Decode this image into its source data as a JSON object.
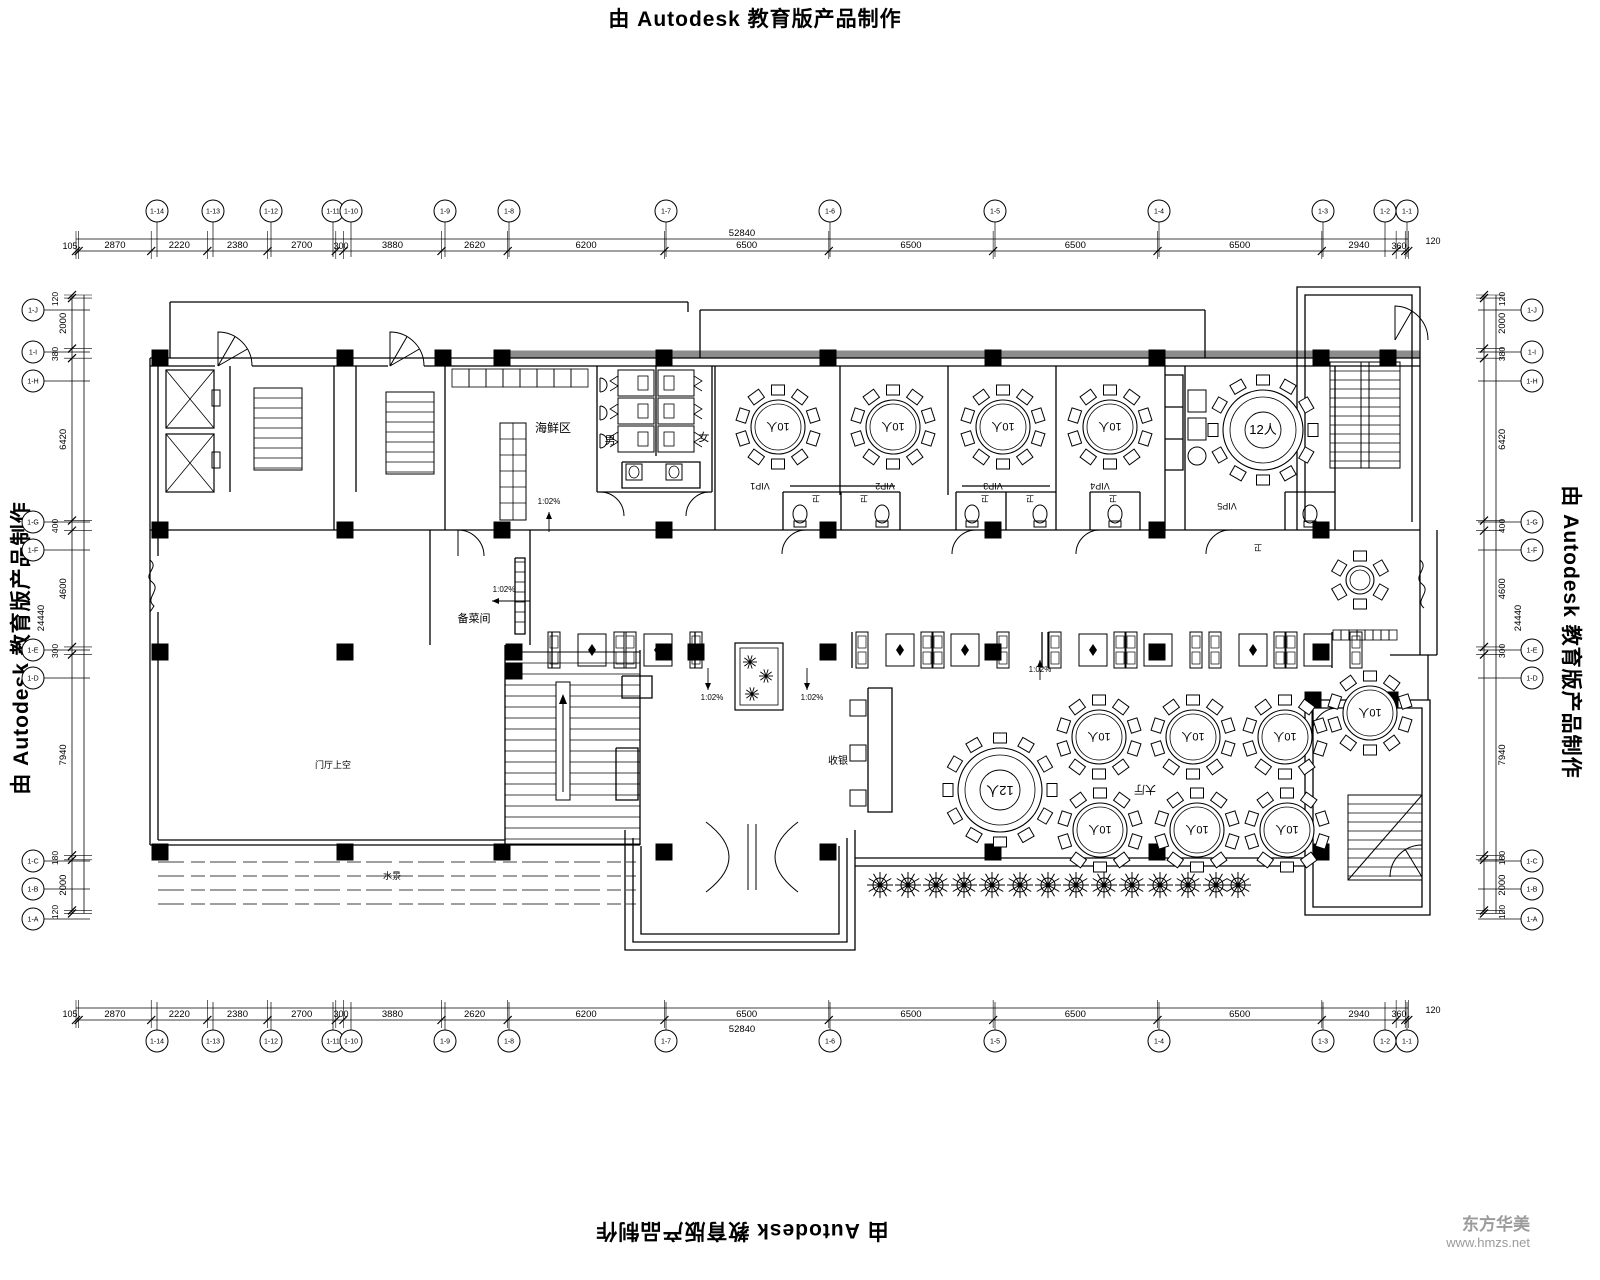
{
  "banner": {
    "text": "由 Autodesk 教育版产品制作"
  },
  "watermark": {
    "company": "东方华美",
    "url": "www.hmzs.net"
  },
  "colors": {
    "ink": "#000000",
    "band": "#8c8c8c",
    "watermark": "#9b9b9b"
  },
  "dimensions": {
    "scale_px_per_mm": 0.025283,
    "horizontal_segments": [
      105,
      2870,
      2220,
      2380,
      2700,
      300,
      3880,
      2620,
      6200,
      6500,
      6500,
      6500,
      6500,
      2940,
      360,
      120
    ],
    "vertical_segments": [
      120,
      2000,
      380,
      6420,
      400,
      4600,
      300,
      7940,
      180,
      2000,
      120
    ],
    "horizontal_overall": "52840",
    "vertical_overall": "24440",
    "top": {
      "origin_x": 76,
      "line_y": 239,
      "line_y2": 251,
      "label_y": 248,
      "overall_xy": [
        742,
        236
      ],
      "extra_labels": [
        {
          "t": "105",
          "x": 70,
          "y": 249
        },
        {
          "t": "300",
          "x": 341,
          "y": 249
        },
        {
          "t": "360",
          "x": 1399,
          "y": 249
        },
        {
          "t": "120",
          "x": 1433,
          "y": 244
        }
      ]
    },
    "bottom": {
      "origin_x": 76,
      "line_y": 1008,
      "line_y2": 1020,
      "label_y": 1017,
      "overall_xy": [
        742,
        1032
      ],
      "extra_labels": [
        {
          "t": "105",
          "x": 70,
          "y": 1017
        },
        {
          "t": "300",
          "x": 341,
          "y": 1017
        },
        {
          "t": "360",
          "x": 1399,
          "y": 1017
        },
        {
          "t": "120",
          "x": 1433,
          "y": 1013
        }
      ]
    },
    "left": {
      "origin_y": 295,
      "line_x": 72,
      "line_x2": 84,
      "label_x": 66,
      "overall_xy": [
        44,
        618
      ],
      "extra_labels": [
        {
          "t": "120",
          "x": 58,
          "y": 299
        },
        {
          "t": "380",
          "x": 58,
          "y": 354
        },
        {
          "t": "400",
          "x": 58,
          "y": 526
        },
        {
          "t": "300",
          "x": 58,
          "y": 651
        },
        {
          "t": "180",
          "x": 58,
          "y": 858
        },
        {
          "t": "120",
          "x": 58,
          "y": 912
        }
      ]
    },
    "right": {
      "origin_y": 295,
      "line_x": 1484,
      "line_x2": 1496,
      "label_x": 1505,
      "overall_xy": [
        1521,
        618
      ],
      "extra_labels": [
        {
          "t": "120",
          "x": 1505,
          "y": 299
        },
        {
          "t": "380",
          "x": 1505,
          "y": 354
        },
        {
          "t": "400",
          "x": 1505,
          "y": 526
        },
        {
          "t": "300",
          "x": 1505,
          "y": 651
        },
        {
          "t": "180",
          "x": 1505,
          "y": 858
        },
        {
          "t": "120",
          "x": 1505,
          "y": 912
        }
      ]
    }
  },
  "grid_bubbles": {
    "radius": 11,
    "top_y": 211,
    "bottom_y": 1041,
    "left_x": 33,
    "right_x": 1532,
    "columns": [
      {
        "x": 157,
        "label": "1-14"
      },
      {
        "x": 213,
        "label": "1-13"
      },
      {
        "x": 271,
        "label": "1-12"
      },
      {
        "x": 333,
        "label": "1-11"
      },
      {
        "x": 351,
        "label": "1-10"
      },
      {
        "x": 445,
        "label": "1-9"
      },
      {
        "x": 509,
        "label": "1-8"
      },
      {
        "x": 666,
        "label": "1-7"
      },
      {
        "x": 830,
        "label": "1-6"
      },
      {
        "x": 995,
        "label": "1-5"
      },
      {
        "x": 1159,
        "label": "1-4"
      },
      {
        "x": 1323,
        "label": "1-3"
      },
      {
        "x": 1385,
        "label": "1-2"
      },
      {
        "x": 1407,
        "label": "1-1"
      }
    ],
    "rows": [
      {
        "y": 310,
        "label": "1-J"
      },
      {
        "y": 352,
        "label": "1-I"
      },
      {
        "y": 381,
        "label": "1-H"
      },
      {
        "y": 522,
        "label": "1-G"
      },
      {
        "y": 550,
        "label": "1-F"
      },
      {
        "y": 650,
        "label": "1-E"
      },
      {
        "y": 678,
        "label": "1-D"
      },
      {
        "y": 861,
        "label": "1-C"
      },
      {
        "y": 889,
        "label": "1-B"
      },
      {
        "y": 919,
        "label": "1-A"
      }
    ]
  },
  "rooms": {
    "labels": [
      {
        "t": "海鲜区",
        "x": 553,
        "y": 432,
        "s": 12,
        "rot": 0
      },
      {
        "t": "男",
        "x": 610,
        "y": 444,
        "s": 11,
        "rot": 0
      },
      {
        "t": "女",
        "x": 704,
        "y": 441,
        "s": 11,
        "rot": 0
      },
      {
        "t": "VIP1",
        "x": 760,
        "y": 483,
        "s": 9,
        "rot": 180
      },
      {
        "t": "VIP2",
        "x": 885,
        "y": 483,
        "s": 9,
        "rot": 180
      },
      {
        "t": "VIP3",
        "x": 993,
        "y": 483,
        "s": 9,
        "rot": 180
      },
      {
        "t": "VIP4",
        "x": 1100,
        "y": 483,
        "s": 9,
        "rot": 180
      },
      {
        "t": "VIP5",
        "x": 1227,
        "y": 503,
        "s": 9,
        "rot": 180
      },
      {
        "t": "卫",
        "x": 816,
        "y": 496,
        "s": 8,
        "rot": 180
      },
      {
        "t": "卫",
        "x": 864,
        "y": 496,
        "s": 8,
        "rot": 180
      },
      {
        "t": "卫",
        "x": 985,
        "y": 496,
        "s": 8,
        "rot": 180
      },
      {
        "t": "卫",
        "x": 1030,
        "y": 496,
        "s": 8,
        "rot": 180
      },
      {
        "t": "卫",
        "x": 1113,
        "y": 496,
        "s": 8,
        "rot": 180
      },
      {
        "t": "卫",
        "x": 1258,
        "y": 545,
        "s": 8,
        "rot": 180
      },
      {
        "t": "备菜间",
        "x": 474,
        "y": 622,
        "s": 11,
        "rot": 0
      },
      {
        "t": "收银",
        "x": 838,
        "y": 764,
        "s": 10,
        "rot": 0
      },
      {
        "t": "大厅",
        "x": 1145,
        "y": 786,
        "s": 11,
        "rot": 180
      },
      {
        "t": "门厅上空",
        "x": 333,
        "y": 768,
        "s": 9,
        "rot": 0
      },
      {
        "t": "水景",
        "x": 392,
        "y": 879,
        "s": 9,
        "rot": 0
      }
    ]
  },
  "notes": {
    "slope_text": "1:02%",
    "items": [
      {
        "x": 549,
        "y": 504,
        "arrow": [
          549,
          532,
          549,
          512
        ]
      },
      {
        "x": 504,
        "y": 592,
        "arrow": [
          530,
          601,
          492,
          601
        ]
      },
      {
        "x": 712,
        "y": 700,
        "arrow": [
          708,
          668,
          708,
          690
        ]
      },
      {
        "x": 812,
        "y": 700,
        "arrow": [
          807,
          668,
          807,
          690
        ]
      },
      {
        "x": 1040,
        "y": 672,
        "arrow": [
          1040,
          680,
          1040,
          660
        ]
      }
    ]
  },
  "tables": {
    "round": [
      {
        "x": 778,
        "y": 427,
        "r": 27,
        "chairs": 10,
        "label": "10人",
        "rot": 180,
        "ls": 11
      },
      {
        "x": 893,
        "y": 427,
        "r": 27,
        "chairs": 10,
        "label": "10人",
        "rot": 180,
        "ls": 11
      },
      {
        "x": 1003,
        "y": 427,
        "r": 27,
        "chairs": 10,
        "label": "10人",
        "rot": 180,
        "ls": 11
      },
      {
        "x": 1110,
        "y": 427,
        "r": 27,
        "chairs": 10,
        "label": "10人",
        "rot": 180,
        "ls": 11
      },
      {
        "x": 1263,
        "y": 430,
        "r": 40,
        "chairs": 12,
        "label": "12人",
        "rot": 0,
        "ls": 13,
        "ring": 33,
        "core": 18
      },
      {
        "x": 1000,
        "y": 790,
        "r": 42,
        "chairs": 12,
        "label": "12人",
        "rot": 180,
        "ls": 13,
        "ring": 35,
        "core": 20
      },
      {
        "x": 1099,
        "y": 737,
        "r": 27,
        "chairs": 10,
        "label": "10人",
        "rot": 180,
        "ls": 11
      },
      {
        "x": 1193,
        "y": 737,
        "r": 27,
        "chairs": 10,
        "label": "10人",
        "rot": 180,
        "ls": 11
      },
      {
        "x": 1285,
        "y": 737,
        "r": 27,
        "chairs": 10,
        "label": "10人",
        "rot": 180,
        "ls": 11
      },
      {
        "x": 1100,
        "y": 830,
        "r": 27,
        "chairs": 10,
        "label": "10人",
        "rot": 180,
        "ls": 11
      },
      {
        "x": 1197,
        "y": 830,
        "r": 27,
        "chairs": 10,
        "label": "10人",
        "rot": 180,
        "ls": 11
      },
      {
        "x": 1287,
        "y": 830,
        "r": 27,
        "chairs": 10,
        "label": "10人",
        "rot": 180,
        "ls": 11
      },
      {
        "x": 1370,
        "y": 713,
        "r": 27,
        "chairs": 10,
        "label": "10人",
        "rot": 180,
        "ls": 11
      },
      {
        "x": 1360,
        "y": 580,
        "r": 14,
        "chairs": 6,
        "label": "",
        "rot": 0,
        "ls": 0
      }
    ]
  },
  "booths": {
    "centers": [
      592,
      658,
      900,
      965,
      1093,
      1158,
      1253,
      1318
    ],
    "y": 632
  },
  "trees": {
    "y": 885,
    "xs": [
      880,
      908,
      936,
      964,
      992,
      1020,
      1048,
      1076,
      1104,
      1132,
      1160,
      1188,
      1216,
      1238
    ]
  },
  "columns": {
    "size": 17,
    "points": [
      [
        160,
        358
      ],
      [
        345,
        358
      ],
      [
        443,
        358
      ],
      [
        502,
        358
      ],
      [
        664,
        358
      ],
      [
        828,
        358
      ],
      [
        993,
        358
      ],
      [
        1157,
        358
      ],
      [
        1321,
        358
      ],
      [
        1388,
        358
      ],
      [
        160,
        530
      ],
      [
        345,
        530
      ],
      [
        502,
        530
      ],
      [
        664,
        530
      ],
      [
        828,
        530
      ],
      [
        993,
        530
      ],
      [
        1157,
        530
      ],
      [
        1321,
        530
      ],
      [
        160,
        652
      ],
      [
        345,
        652
      ],
      [
        514,
        652
      ],
      [
        514,
        671
      ],
      [
        664,
        652
      ],
      [
        696,
        652
      ],
      [
        828,
        652
      ],
      [
        993,
        652
      ],
      [
        1157,
        652
      ],
      [
        1321,
        652
      ],
      [
        160,
        852
      ],
      [
        345,
        852
      ],
      [
        502,
        852
      ],
      [
        664,
        852
      ],
      [
        828,
        852
      ],
      [
        993,
        852
      ],
      [
        1157,
        852
      ],
      [
        1321,
        852
      ],
      [
        1313,
        700
      ],
      [
        1390,
        700
      ]
    ]
  }
}
